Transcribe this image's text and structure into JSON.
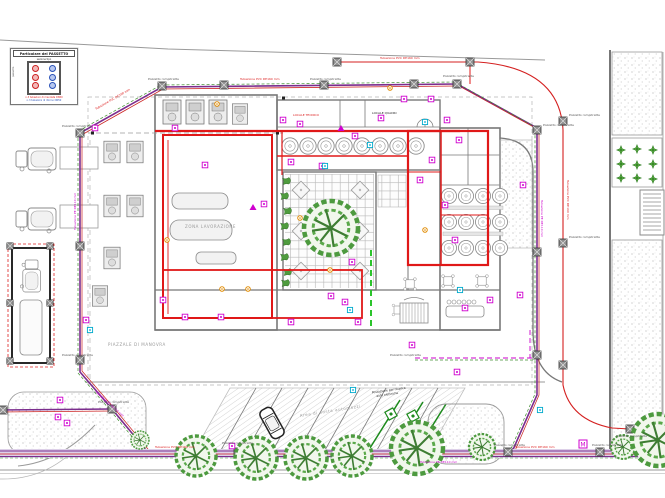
{
  "drawing": {
    "legend": {
      "title": "Particolare del PASSETTO",
      "note": "sezione tipo",
      "side": "passetto",
      "caption_red": "n.3 tubazioni di mandata DN50",
      "caption_blue": "n.3 tubazioni di ritorno DN50"
    },
    "labels": {
      "pozzetto": "Pozzetto rompitratta",
      "pipe_red": "Tubazione PVC DE160 mm",
      "pipe_mag": "Tubazione PE DE110 mm",
      "room_a": "LOCALE TECNICO",
      "room_b": "LOCALE QUADRI",
      "area_hall": "ZONA LAVORAZIONE",
      "area_yard": "PIAZZALE DI MANOVRA",
      "area_parking": "Area di sosta automezzi",
      "charging_1": "Postazione per ricarica",
      "charging_2": "auto elettriche"
    },
    "colors": {
      "pipe_red": "#dd1a1a",
      "pipe_purple": "#7b2d8e",
      "pipe_green": "#3f8f2f",
      "tag_magenta": "#cc00cc",
      "tag_cyan": "#00aacc",
      "tree_green": "#4d9a3f",
      "band_lavender": "#ddd0e8"
    }
  }
}
